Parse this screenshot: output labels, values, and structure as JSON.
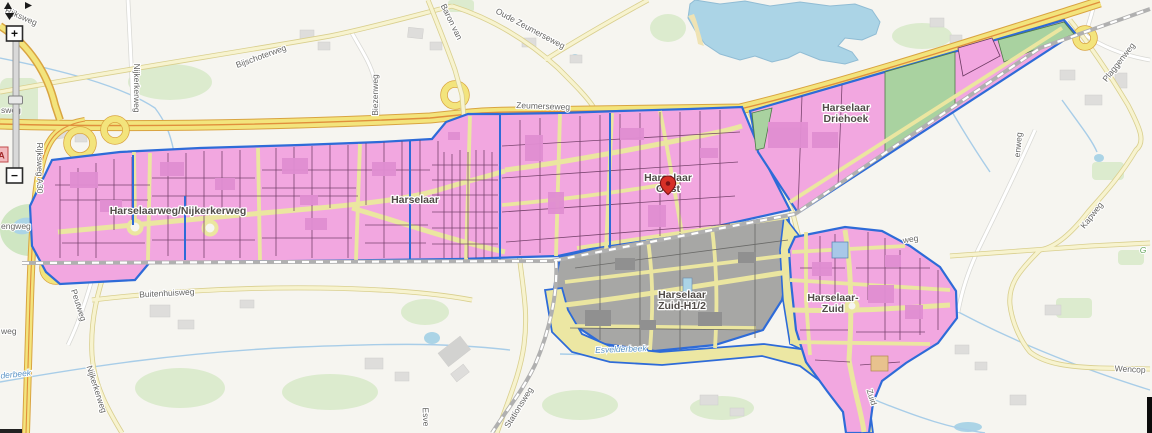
{
  "map": {
    "area_labels": {
      "west": "Harselaarweg/Nijkerkerweg",
      "harselaar": "Harselaar",
      "oost1": "Harselaar",
      "oost2": "Oost",
      "driehoek1": "Harselaar",
      "driehoek2": "Driehoek",
      "zuidh1": "Harselaar",
      "zuidh2": "Zuid-H1/2",
      "zuid1": "Harselaar-",
      "zuid2": "Zuid"
    },
    "road_labels": {
      "rijksweg": "Rijksweg",
      "rijksweg_a30": "Rijksweg A30",
      "nijkerkerweg_n": "Nijkerkerweg",
      "bijschoterweg": "Bijschoterweg",
      "biezenweg": "Biezenweg",
      "baron_van": "Baron van",
      "oude_zeumerseweg": "Oude Zeumerseweg",
      "zeumerseweg": "Zeumerseweg",
      "buitenhuisweg": "Buitenhuisweg",
      "peutweg": "Peutweg",
      "nijkerkerweg_s": "Nijkerkerweg",
      "stationsweg": "Stationsweg",
      "plaggenweg": "Plaggenweg",
      "kapweg": "Kapweg",
      "wencop": "Wencop",
      "zuid_road": "Zuid",
      "weg_frag": "weg",
      "enweg_frag": "enweg",
      "engweg_frag": "engweg",
      "sweg_frag": "sweg",
      "weg_left_frag": "weg",
      "esve_frag": "Esve",
      "g_frag": "G"
    },
    "water_labels": {
      "esvelderbeek": "Esvelderbeek",
      "derbeek_frag": "derbeek"
    },
    "controls": {
      "zoom_in": "+",
      "zoom_out": "−",
      "marker_a": "A"
    },
    "colors": {
      "parcel_pink": "#f2a7e0",
      "parcel_gray": "#a7a7a5",
      "parcel_green": "#a9d2a0",
      "plan_boundary_blue": "#2e6bd8",
      "zone_road_yellow": "#ece7a3",
      "water_blue": "#abd4e6",
      "highway_yellow": "#f3e47c",
      "highway_orange": "#e08f3c"
    }
  }
}
